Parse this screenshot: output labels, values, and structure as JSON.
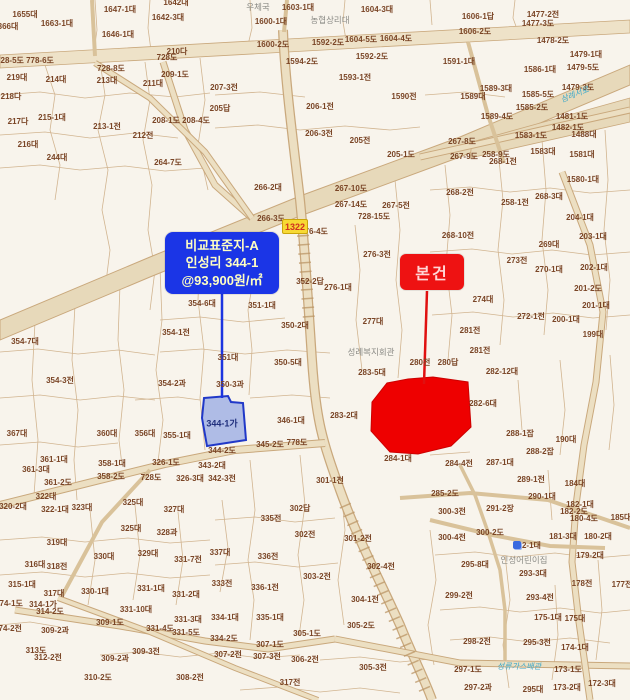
{
  "callouts": {
    "comparison": {
      "line1": "비교표준지-A",
      "line2": "인성리 344-1",
      "line3": "@93,900원/㎡"
    },
    "subject": {
      "label": "본건"
    }
  },
  "route_badge": "1322",
  "highlights": {
    "subject_parcel_color": "#ee0000",
    "comparison_parcel_color": "#7e96e2",
    "comparison_parcel_label": "344-1가"
  },
  "colors": {
    "map_background": "#f8f4ec",
    "parcel_line": "#cbaa80",
    "road_fill": "#ecdfc2",
    "label_text": "#7a4526",
    "callout_blue": "#1b35e6",
    "callout_red": "#ee1212"
  },
  "map": {
    "labels": [
      {
        "t": "1655대",
        "x": 25,
        "y": 15
      },
      {
        "t": "1663-1대",
        "x": 57,
        "y": 24
      },
      {
        "t": "1647-1대",
        "x": 120,
        "y": 10
      },
      {
        "t": "1646-1대",
        "x": 118,
        "y": 35
      },
      {
        "t": "1642-3대",
        "x": 168,
        "y": 18
      },
      {
        "t": "1642대",
        "x": 176,
        "y": 3
      },
      {
        "t": "366대",
        "x": 8,
        "y": 27
      },
      {
        "t": "728-5도",
        "x": 10,
        "y": 61
      },
      {
        "t": "778-6도",
        "x": 40,
        "y": 61
      },
      {
        "t": "728도",
        "x": 167,
        "y": 58
      },
      {
        "t": "210다",
        "x": 177,
        "y": 52
      },
      {
        "t": "209-1도",
        "x": 175,
        "y": 75
      },
      {
        "t": "728-8도",
        "x": 111,
        "y": 69
      },
      {
        "t": "213대",
        "x": 107,
        "y": 81
      },
      {
        "t": "214대",
        "x": 56,
        "y": 80
      },
      {
        "t": "219대",
        "x": 17,
        "y": 78
      },
      {
        "t": "218다",
        "x": 11,
        "y": 97
      },
      {
        "t": "217다",
        "x": 18,
        "y": 122
      },
      {
        "t": "215-1대",
        "x": 52,
        "y": 118
      },
      {
        "t": "216대",
        "x": 28,
        "y": 145
      },
      {
        "t": "244대",
        "x": 57,
        "y": 158
      },
      {
        "t": "213-1전",
        "x": 107,
        "y": 127
      },
      {
        "t": "211대",
        "x": 153,
        "y": 84
      },
      {
        "t": "212전",
        "x": 143,
        "y": 136
      },
      {
        "t": "208-1도",
        "x": 166,
        "y": 121
      },
      {
        "t": "208-4도",
        "x": 196,
        "y": 121
      },
      {
        "t": "264-7도",
        "x": 168,
        "y": 163
      },
      {
        "t": "1603-1대",
        "x": 298,
        "y": 8
      },
      {
        "t": "1604-3대",
        "x": 377,
        "y": 10
      },
      {
        "t": "1600-1대",
        "x": 271,
        "y": 22
      },
      {
        "t": "1600-2도",
        "x": 273,
        "y": 45
      },
      {
        "t": "1592-2도",
        "x": 328,
        "y": 43
      },
      {
        "t": "1604-5도",
        "x": 361,
        "y": 40
      },
      {
        "t": "1604-4도",
        "x": 396,
        "y": 39
      },
      {
        "t": "1592-2도",
        "x": 372,
        "y": 57
      },
      {
        "t": "1594-2도",
        "x": 302,
        "y": 62
      },
      {
        "t": "1593-1전",
        "x": 355,
        "y": 78
      },
      {
        "t": "1590전",
        "x": 404,
        "y": 97
      },
      {
        "t": "207-3전",
        "x": 224,
        "y": 88
      },
      {
        "t": "205답",
        "x": 220,
        "y": 109
      },
      {
        "t": "206-1전",
        "x": 320,
        "y": 107
      },
      {
        "t": "206-3전",
        "x": 319,
        "y": 134
      },
      {
        "t": "205전",
        "x": 360,
        "y": 141
      },
      {
        "t": "205-1도",
        "x": 401,
        "y": 155
      },
      {
        "t": "1606-1답",
        "x": 478,
        "y": 17
      },
      {
        "t": "1477-2전",
        "x": 543,
        "y": 15
      },
      {
        "t": "1477-3도",
        "x": 538,
        "y": 24
      },
      {
        "t": "1606-2도",
        "x": 475,
        "y": 32
      },
      {
        "t": "1478-2도",
        "x": 553,
        "y": 41
      },
      {
        "t": "1479-1대",
        "x": 586,
        "y": 55
      },
      {
        "t": "1479-5도",
        "x": 583,
        "y": 68
      },
      {
        "t": "1591-1대",
        "x": 459,
        "y": 62
      },
      {
        "t": "1586-1대",
        "x": 540,
        "y": 70
      },
      {
        "t": "1589-3대",
        "x": 496,
        "y": 89
      },
      {
        "t": "1589대",
        "x": 473,
        "y": 97
      },
      {
        "t": "1585-5도",
        "x": 538,
        "y": 95
      },
      {
        "t": "1585-2도",
        "x": 532,
        "y": 108
      },
      {
        "t": "1479-3도",
        "x": 578,
        "y": 88
      },
      {
        "t": "1589-4도",
        "x": 497,
        "y": 117
      },
      {
        "t": "1481-1도",
        "x": 572,
        "y": 117
      },
      {
        "t": "1482-1도",
        "x": 568,
        "y": 128
      },
      {
        "t": "1583-1도",
        "x": 531,
        "y": 136
      },
      {
        "t": "1488대",
        "x": 584,
        "y": 135
      },
      {
        "t": "267-8도",
        "x": 462,
        "y": 142
      },
      {
        "t": "267-9도",
        "x": 464,
        "y": 157
      },
      {
        "t": "258-9도",
        "x": 496,
        "y": 155
      },
      {
        "t": "268-1전",
        "x": 503,
        "y": 162
      },
      {
        "t": "1583대",
        "x": 543,
        "y": 152
      },
      {
        "t": "1581대",
        "x": 582,
        "y": 155
      },
      {
        "t": "266-2대",
        "x": 268,
        "y": 188
      },
      {
        "t": "267-10도",
        "x": 351,
        "y": 189
      },
      {
        "t": "267-14도",
        "x": 351,
        "y": 205
      },
      {
        "t": "267-5전",
        "x": 396,
        "y": 206
      },
      {
        "t": "728-15도",
        "x": 374,
        "y": 217
      },
      {
        "t": "266-3도",
        "x": 271,
        "y": 219
      },
      {
        "t": "276-4도",
        "x": 314,
        "y": 232
      },
      {
        "t": "276-3전",
        "x": 377,
        "y": 255
      },
      {
        "t": "276-1대",
        "x": 338,
        "y": 288
      },
      {
        "t": "277대",
        "x": 373,
        "y": 322
      },
      {
        "t": "352-2답",
        "x": 310,
        "y": 282
      },
      {
        "t": "351-1대",
        "x": 262,
        "y": 306
      },
      {
        "t": "350-2대",
        "x": 295,
        "y": 326
      },
      {
        "t": "354-6대",
        "x": 202,
        "y": 304
      },
      {
        "t": "268-2전",
        "x": 460,
        "y": 193
      },
      {
        "t": "258-1전",
        "x": 515,
        "y": 203
      },
      {
        "t": "268-3대",
        "x": 549,
        "y": 197
      },
      {
        "t": "1580-1대",
        "x": 583,
        "y": 180
      },
      {
        "t": "204-1대",
        "x": 580,
        "y": 218
      },
      {
        "t": "203-1대",
        "x": 593,
        "y": 237
      },
      {
        "t": "268-10전",
        "x": 458,
        "y": 236
      },
      {
        "t": "269대",
        "x": 549,
        "y": 245
      },
      {
        "t": "273전",
        "x": 517,
        "y": 261
      },
      {
        "t": "270-1대",
        "x": 549,
        "y": 270
      },
      {
        "t": "202-1대",
        "x": 594,
        "y": 268
      },
      {
        "t": "274대",
        "x": 483,
        "y": 300
      },
      {
        "t": "272-1전",
        "x": 531,
        "y": 317
      },
      {
        "t": "200-1대",
        "x": 566,
        "y": 320
      },
      {
        "t": "201-1대",
        "x": 596,
        "y": 306
      },
      {
        "t": "201-2도",
        "x": 588,
        "y": 289
      },
      {
        "t": "199대",
        "x": 593,
        "y": 335
      },
      {
        "t": "281전",
        "x": 470,
        "y": 331
      },
      {
        "t": "281전",
        "x": 480,
        "y": 351
      },
      {
        "t": "282-12대",
        "x": 502,
        "y": 372
      },
      {
        "t": "282-6대",
        "x": 483,
        "y": 404
      },
      {
        "t": "280전",
        "x": 420,
        "y": 363
      },
      {
        "t": "280답",
        "x": 448,
        "y": 363
      },
      {
        "t": "283-5대",
        "x": 372,
        "y": 373
      },
      {
        "t": "283-2대",
        "x": 344,
        "y": 416
      },
      {
        "t": "284-1대",
        "x": 398,
        "y": 459
      },
      {
        "t": "284-4전",
        "x": 459,
        "y": 464
      },
      {
        "t": "287-1대",
        "x": 500,
        "y": 463
      },
      {
        "t": "354-1전",
        "x": 176,
        "y": 333
      },
      {
        "t": "351대",
        "x": 228,
        "y": 358
      },
      {
        "t": "350-5대",
        "x": 288,
        "y": 363
      },
      {
        "t": "354-2과",
        "x": 172,
        "y": 384
      },
      {
        "t": "350-3과",
        "x": 230,
        "y": 385
      },
      {
        "t": "346-1대",
        "x": 291,
        "y": 421
      },
      {
        "t": "356대",
        "x": 145,
        "y": 434
      },
      {
        "t": "355-1대",
        "x": 177,
        "y": 436
      },
      {
        "t": "345-2도",
        "x": 270,
        "y": 445
      },
      {
        "t": "778도",
        "x": 297,
        "y": 443
      },
      {
        "t": "344-2도",
        "x": 222,
        "y": 451
      },
      {
        "t": "326-1도",
        "x": 166,
        "y": 463
      },
      {
        "t": "343-2대",
        "x": 212,
        "y": 466
      },
      {
        "t": "342-3전",
        "x": 222,
        "y": 479
      },
      {
        "t": "354-3전",
        "x": 60,
        "y": 381
      },
      {
        "t": "354-7대",
        "x": 25,
        "y": 342
      },
      {
        "t": "367대",
        "x": 17,
        "y": 434
      },
      {
        "t": "360대",
        "x": 107,
        "y": 434
      },
      {
        "t": "361-1대",
        "x": 54,
        "y": 460
      },
      {
        "t": "361-3대",
        "x": 36,
        "y": 470
      },
      {
        "t": "358-1대",
        "x": 112,
        "y": 464
      },
      {
        "t": "358-2도",
        "x": 111,
        "y": 477
      },
      {
        "t": "326-3대",
        "x": 190,
        "y": 479
      },
      {
        "t": "728도",
        "x": 151,
        "y": 478
      },
      {
        "t": "361-2도",
        "x": 58,
        "y": 483
      },
      {
        "t": "322대",
        "x": 46,
        "y": 497
      },
      {
        "t": "320-2대",
        "x": 13,
        "y": 507
      },
      {
        "t": "322-1대",
        "x": 55,
        "y": 510
      },
      {
        "t": "323대",
        "x": 82,
        "y": 508
      },
      {
        "t": "325대",
        "x": 133,
        "y": 503
      },
      {
        "t": "327대",
        "x": 174,
        "y": 510
      },
      {
        "t": "325대",
        "x": 131,
        "y": 529
      },
      {
        "t": "328과",
        "x": 167,
        "y": 533
      },
      {
        "t": "319대",
        "x": 57,
        "y": 543
      },
      {
        "t": "330대",
        "x": 104,
        "y": 557
      },
      {
        "t": "329대",
        "x": 148,
        "y": 554
      },
      {
        "t": "331-7전",
        "x": 188,
        "y": 560
      },
      {
        "t": "316대",
        "x": 35,
        "y": 565
      },
      {
        "t": "318전",
        "x": 57,
        "y": 567
      },
      {
        "t": "315-1대",
        "x": 22,
        "y": 585
      },
      {
        "t": "317대",
        "x": 54,
        "y": 594
      },
      {
        "t": "330-1대",
        "x": 95,
        "y": 592
      },
      {
        "t": "331-1대",
        "x": 151,
        "y": 589
      },
      {
        "t": "331-2대",
        "x": 186,
        "y": 595
      },
      {
        "t": "314-1가",
        "x": 43,
        "y": 605
      },
      {
        "t": "314-2도",
        "x": 50,
        "y": 612
      },
      {
        "t": "309-1도",
        "x": 110,
        "y": 623
      },
      {
        "t": "331-10대",
        "x": 136,
        "y": 610
      },
      {
        "t": "331-3대",
        "x": 188,
        "y": 620
      },
      {
        "t": "309-2과",
        "x": 55,
        "y": 631
      },
      {
        "t": "331-4도",
        "x": 160,
        "y": 629
      },
      {
        "t": "331-5도",
        "x": 186,
        "y": 633
      },
      {
        "t": "334-1대",
        "x": 225,
        "y": 618
      },
      {
        "t": "335-1대",
        "x": 270,
        "y": 618
      },
      {
        "t": "334-2도",
        "x": 224,
        "y": 639
      },
      {
        "t": "305-1도",
        "x": 307,
        "y": 634
      },
      {
        "t": "307-1도",
        "x": 270,
        "y": 645
      },
      {
        "t": "307-2전",
        "x": 228,
        "y": 655
      },
      {
        "t": "307-3전",
        "x": 267,
        "y": 657
      },
      {
        "t": "306-2전",
        "x": 305,
        "y": 660
      },
      {
        "t": "309-3전",
        "x": 146,
        "y": 652
      },
      {
        "t": "309-2과",
        "x": 115,
        "y": 659
      },
      {
        "t": "313도",
        "x": 36,
        "y": 651
      },
      {
        "t": "312-2전",
        "x": 48,
        "y": 658
      },
      {
        "t": "310-2도",
        "x": 98,
        "y": 678
      },
      {
        "t": "308-2전",
        "x": 190,
        "y": 678
      },
      {
        "t": "317전",
        "x": 290,
        "y": 683
      },
      {
        "t": "374-1도",
        "x": 9,
        "y": 604
      },
      {
        "t": "374-2전",
        "x": 8,
        "y": 629
      },
      {
        "t": "301-1전",
        "x": 330,
        "y": 481
      },
      {
        "t": "335전",
        "x": 271,
        "y": 519
      },
      {
        "t": "302답",
        "x": 300,
        "y": 509
      },
      {
        "t": "302전",
        "x": 305,
        "y": 535
      },
      {
        "t": "301-2전",
        "x": 358,
        "y": 539
      },
      {
        "t": "337대",
        "x": 220,
        "y": 553
      },
      {
        "t": "336전",
        "x": 268,
        "y": 557
      },
      {
        "t": "333전",
        "x": 222,
        "y": 584
      },
      {
        "t": "336-1전",
        "x": 265,
        "y": 588
      },
      {
        "t": "303-2전",
        "x": 317,
        "y": 577
      },
      {
        "t": "304-1전",
        "x": 365,
        "y": 600
      },
      {
        "t": "302-4전",
        "x": 381,
        "y": 567
      },
      {
        "t": "300-3전",
        "x": 452,
        "y": 512
      },
      {
        "t": "300-4전",
        "x": 452,
        "y": 538
      },
      {
        "t": "285-2도",
        "x": 445,
        "y": 494
      },
      {
        "t": "305-2도",
        "x": 361,
        "y": 626
      },
      {
        "t": "298-2전",
        "x": 477,
        "y": 642
      },
      {
        "t": "305-3전",
        "x": 373,
        "y": 668
      },
      {
        "t": "297-1도",
        "x": 468,
        "y": 670
      },
      {
        "t": "297-2과",
        "x": 478,
        "y": 688
      },
      {
        "t": "299-2전",
        "x": 459,
        "y": 596
      },
      {
        "t": "288-1잡",
        "x": 520,
        "y": 434
      },
      {
        "t": "288-2잡",
        "x": 540,
        "y": 452
      },
      {
        "t": "190대",
        "x": 566,
        "y": 440
      },
      {
        "t": "289-1전",
        "x": 531,
        "y": 480
      },
      {
        "t": "184대",
        "x": 575,
        "y": 484
      },
      {
        "t": "290-1대",
        "x": 542,
        "y": 497
      },
      {
        "t": "182-1대",
        "x": 580,
        "y": 505
      },
      {
        "t": "182-2도",
        "x": 574,
        "y": 512
      },
      {
        "t": "180-4도",
        "x": 584,
        "y": 519
      },
      {
        "t": "185대",
        "x": 621,
        "y": 518
      },
      {
        "t": "291-2장",
        "x": 500,
        "y": 509
      },
      {
        "t": "300-2도",
        "x": 490,
        "y": 533
      },
      {
        "t": "181-3대",
        "x": 563,
        "y": 537
      },
      {
        "t": "180-2대",
        "x": 598,
        "y": 537
      },
      {
        "t": "292-1대",
        "x": 527,
        "y": 546
      },
      {
        "t": "179-2대",
        "x": 590,
        "y": 556
      },
      {
        "t": "295-8대",
        "x": 475,
        "y": 565
      },
      {
        "t": "293-3대",
        "x": 533,
        "y": 574
      },
      {
        "t": "178전",
        "x": 582,
        "y": 584
      },
      {
        "t": "177전",
        "x": 622,
        "y": 585
      },
      {
        "t": "293-4전",
        "x": 540,
        "y": 598
      },
      {
        "t": "175-1대",
        "x": 548,
        "y": 618
      },
      {
        "t": "175대",
        "x": 575,
        "y": 619
      },
      {
        "t": "295-3전",
        "x": 537,
        "y": 643
      },
      {
        "t": "174-1대",
        "x": 575,
        "y": 648
      },
      {
        "t": "173-1도",
        "x": 568,
        "y": 670
      },
      {
        "t": "173-2대",
        "x": 567,
        "y": 688
      },
      {
        "t": "172-3대",
        "x": 602,
        "y": 684
      },
      {
        "t": "295대",
        "x": 533,
        "y": 690
      },
      {
        "t": "344-1가",
        "x": 222,
        "y": 424,
        "c": "navy"
      },
      {
        "t": "우체국",
        "x": 258,
        "y": 7,
        "c": "gray"
      },
      {
        "t": "농협상리대",
        "x": 330,
        "y": 20,
        "c": "gray"
      },
      {
        "t": "성례복지회관",
        "x": 371,
        "y": 352,
        "c": "gray"
      },
      {
        "t": "인성어린이집",
        "x": 524,
        "y": 560,
        "c": "gray"
      },
      {
        "t": "삼례서로",
        "x": 575,
        "y": 95,
        "c": "cyan",
        "r": -22
      },
      {
        "t": "성류가스배관",
        "x": 519,
        "y": 667,
        "c": "cyan"
      }
    ]
  }
}
